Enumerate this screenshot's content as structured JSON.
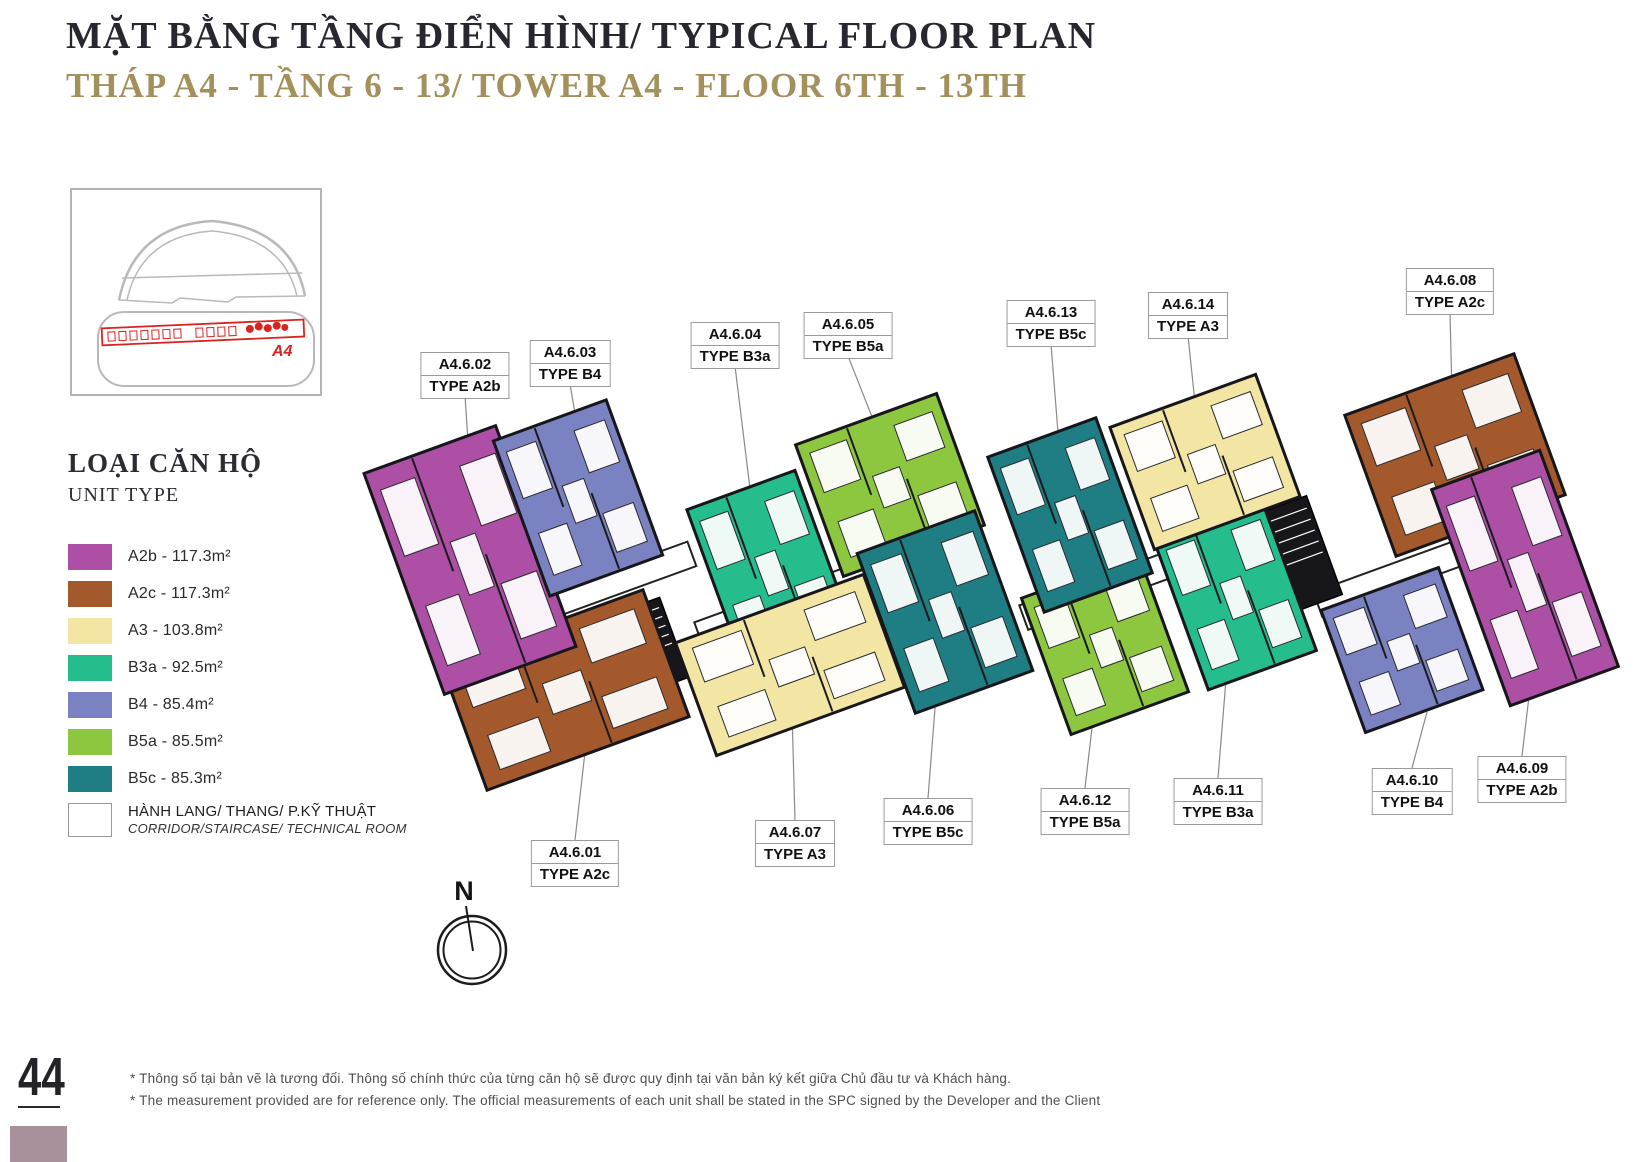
{
  "header": {
    "title": "MẶT BẰNG TẦNG ĐIỂN HÌNH/ TYPICAL FLOOR PLAN",
    "subtitle": "THÁP A4 - TẦNG 6 - 13/ TOWER A4 - FLOOR 6TH - 13TH"
  },
  "minimap": {
    "tower_label": "A4"
  },
  "legend": {
    "title": "LOẠI CĂN HỘ",
    "subtitle": "UNIT TYPE",
    "entries": [
      {
        "key": "A2b",
        "label": "A2b - 117.3m²"
      },
      {
        "key": "A2c",
        "label": "A2c - 117.3m²"
      },
      {
        "key": "A3",
        "label": "A3 - 103.8m²"
      },
      {
        "key": "B3a",
        "label": "B3a - 92.5m²"
      },
      {
        "key": "B4",
        "label": "B4 - 85.4m²"
      },
      {
        "key": "B5a",
        "label": "B5a - 85.5m²"
      },
      {
        "key": "B5c",
        "label": "B5c - 85.3m²"
      },
      {
        "key": "corridor",
        "label": "HÀNH LANG/ THANG/ P.KỸ THUẬT",
        "sub": "CORRIDOR/STAIRCASE/ TECHNICAL ROOM"
      }
    ]
  },
  "colors": {
    "A2b": "#ac4fa5",
    "A2c": "#a3592b",
    "A3": "#f3e5a4",
    "B3a": "#25bc8e",
    "B4": "#7a82c1",
    "B5a": "#8dc63f",
    "B5c": "#1e7e83",
    "corridor": "#ffffff",
    "wall": "#17171b",
    "leader": "#8a8a8a",
    "red": "#d9241f",
    "minimap_gray": "#b9b9b9",
    "title": "#27272f",
    "subtitle_gold": "#a3905a",
    "page_square": "#a8919d"
  },
  "floor_plan": {
    "compass_label": "N",
    "units": [
      {
        "number": "A4.6.01",
        "type": "TYPE A2c",
        "type_key": "A2c"
      },
      {
        "number": "A4.6.02",
        "type": "TYPE A2b",
        "type_key": "A2b"
      },
      {
        "number": "A4.6.03",
        "type": "TYPE B4",
        "type_key": "B4"
      },
      {
        "number": "A4.6.04",
        "type": "TYPE B3a",
        "type_key": "B3a"
      },
      {
        "number": "A4.6.05",
        "type": "TYPE B5a",
        "type_key": "B5a"
      },
      {
        "number": "A4.6.06",
        "type": "TYPE B5c",
        "type_key": "B5c"
      },
      {
        "number": "A4.6.07",
        "type": "TYPE A3",
        "type_key": "A3"
      },
      {
        "number": "A4.6.08",
        "type": "TYPE A2c",
        "type_key": "A2c"
      },
      {
        "number": "A4.6.09",
        "type": "TYPE A2b",
        "type_key": "A2b"
      },
      {
        "number": "A4.6.10",
        "type": "TYPE B4",
        "type_key": "B4"
      },
      {
        "number": "A4.6.11",
        "type": "TYPE B3a",
        "type_key": "B3a"
      },
      {
        "number": "A4.6.12",
        "type": "TYPE B5a",
        "type_key": "B5a"
      },
      {
        "number": "A4.6.13",
        "type": "TYPE B5c",
        "type_key": "B5c"
      },
      {
        "number": "A4.6.14",
        "type": "TYPE A3",
        "type_key": "A3"
      }
    ]
  },
  "footer": {
    "page_number": "44",
    "note_vi": "* Thông số tại bản vẽ là tương đối. Thông số chính thức của từng căn hộ sẽ được quy định tại văn bản ký kết giữa Chủ đầu tư và Khách hàng.",
    "note_en": "* The measurement provided are for reference only. The official measurements of each unit shall be stated in the SPC signed by the Developer and the Client"
  }
}
